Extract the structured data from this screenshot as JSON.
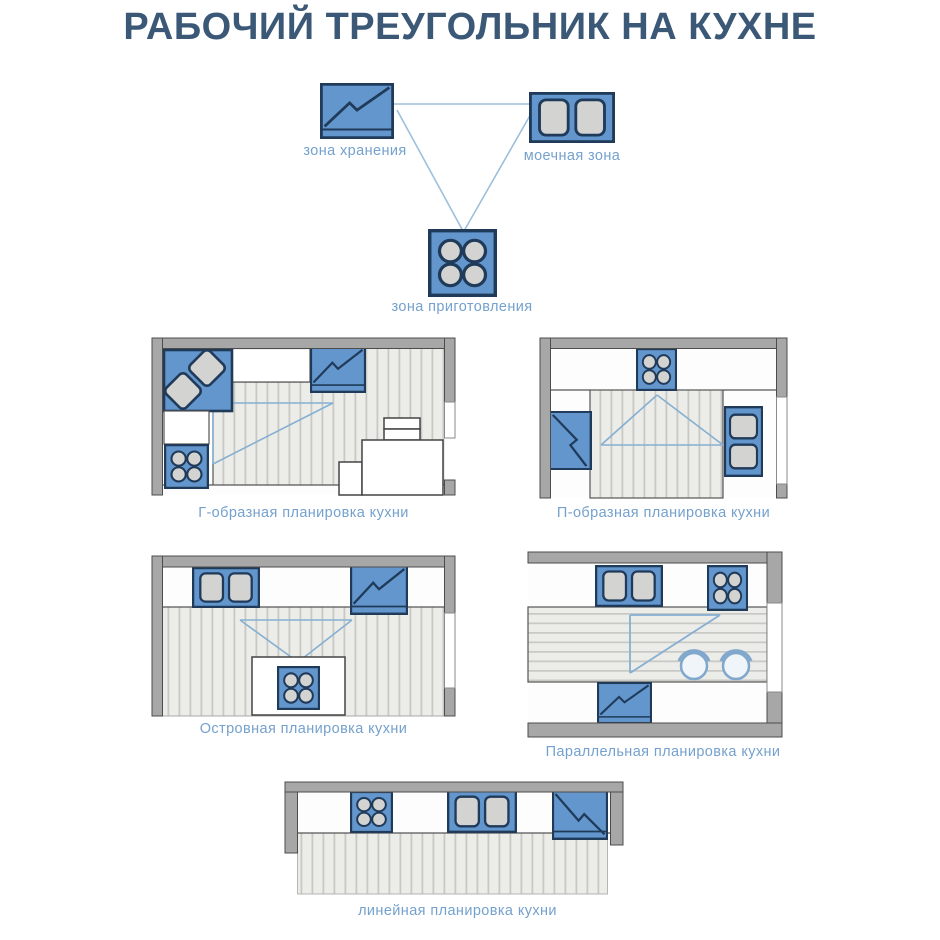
{
  "title": "РАБОЧИЙ ТРЕУГОЛЬНИК НА КУХНЕ",
  "triangle_diagram": {
    "nodes": [
      {
        "id": "storage",
        "icon": "fridge-icon",
        "label": "зона хранения"
      },
      {
        "id": "washing",
        "icon": "sink-icon",
        "label": "моечная зона"
      },
      {
        "id": "cooking",
        "icon": "stove-icon",
        "label": "зона приготовления"
      }
    ]
  },
  "layouts": [
    {
      "id": "l-shaped",
      "label": "Г-образная планировка кухни"
    },
    {
      "id": "u-shaped",
      "label": "П-образная планировка кухни"
    },
    {
      "id": "island",
      "label": "Островная планировка кухни"
    },
    {
      "id": "parallel",
      "label": "Параллельная планировка кухни"
    },
    {
      "id": "linear",
      "label": "линейная планировка кухни"
    }
  ],
  "colors": {
    "title": "#3b5977",
    "label": "#74a1cd",
    "appliance_blue": "#6296cc",
    "appliance_outline": "#203a5a",
    "appliance_inner": "#d3d3d1",
    "wall_gray": "#a7a7a7",
    "floor": "#ecece9",
    "floor_stripe": "#c8c8c5",
    "triangle_line": "#95badb"
  }
}
